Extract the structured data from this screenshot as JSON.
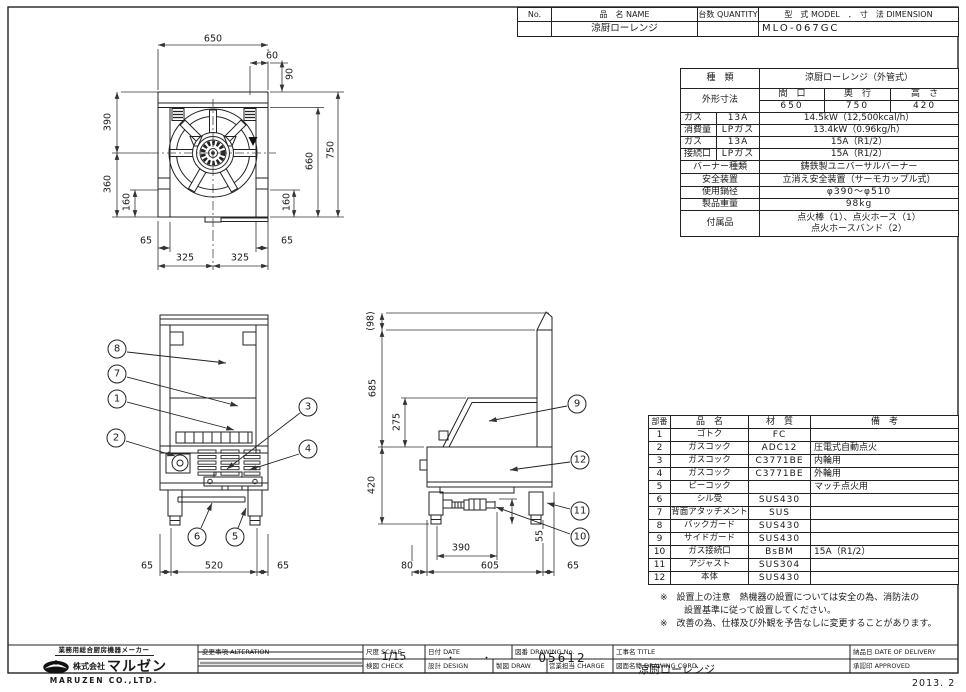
{
  "doc_header": {
    "no_label": "No.",
    "name_label": "品　名 NAME",
    "qty_label": "台数 QUANTITY",
    "model_label": "型　式 MODEL　．　寸　法 DIMENSION",
    "name_value": "涼厨ローレンジ",
    "model_value": "MLO-067GC"
  },
  "spec_table": {
    "kind_label": "種　類",
    "kind_value": "涼厨ローレンジ（外管式）",
    "dims_label": "外形寸法",
    "dims_cols": [
      "間　口",
      "奥　行",
      "高　さ"
    ],
    "dims_vals": [
      "650",
      "750",
      "420"
    ],
    "gas_rows": [
      {
        "c1": "ガス",
        "c2": "13A",
        "c3": "14.5kW（12,500kcal/h）"
      },
      {
        "c1": "消費量",
        "c2": "LPガス",
        "c3": "13.4kW（0.96kg/h）"
      },
      {
        "c1": "ガス",
        "c2": "13A",
        "c3": "15A（R1/2）"
      },
      {
        "c1": "接続口",
        "c2": "LPガス",
        "c3": "15A（R1/2）"
      }
    ],
    "info_rows": [
      {
        "label": "バーナー種類",
        "value": "鋳鉄製ユニバーサルバーナー"
      },
      {
        "label": "安全装置",
        "value": "立消え安全装置（サーモカップル式）"
      },
      {
        "label": "使用鍋径",
        "value": "φ390～φ510"
      },
      {
        "label": "製品重量",
        "value": "98kg"
      }
    ],
    "accessory_label": "付属品",
    "accessory_line1": "点火棒（1）、点火ホース（1）",
    "accessory_line2": "点火ホースバンド（2）"
  },
  "parts_table": {
    "headers": [
      "部番",
      "品　名",
      "材　質",
      "備　考"
    ],
    "rows": [
      {
        "no": "1",
        "name": "ゴトク",
        "material": "FC",
        "note": ""
      },
      {
        "no": "2",
        "name": "ガスコック",
        "material": "ADC12",
        "note": "圧電式自動点火"
      },
      {
        "no": "3",
        "name": "ガスコック",
        "material": "C3771BE",
        "note": "内輪用"
      },
      {
        "no": "4",
        "name": "ガスコック",
        "material": "C3771BE",
        "note": "外輪用"
      },
      {
        "no": "5",
        "name": "ピーコック",
        "material": "",
        "note": "マッチ点火用"
      },
      {
        "no": "6",
        "name": "シル受",
        "material": "SUS430",
        "note": ""
      },
      {
        "no": "7",
        "name": "背面アタッチメント",
        "material": "SUS",
        "note": ""
      },
      {
        "no": "8",
        "name": "バックガード",
        "material": "SUS430",
        "note": ""
      },
      {
        "no": "9",
        "name": "サイドガード",
        "material": "SUS430",
        "note": ""
      },
      {
        "no": "10",
        "name": "ガス接続口",
        "material": "BsBM",
        "note": "15A（R1/2）"
      },
      {
        "no": "11",
        "name": "アジャスト",
        "material": "SUS304",
        "note": ""
      },
      {
        "no": "12",
        "name": "本体",
        "material": "SUS430",
        "note": ""
      }
    ]
  },
  "notes": {
    "line1": "※　設置上の注意　熱機器の設置については安全の為、消防法の",
    "line2": "設置基準に従って設置してください。",
    "line3": "※　改善の為、仕様及び外観を予告なしに変更することがあります。"
  },
  "views": {
    "top": {
      "dims": {
        "w650": "650",
        "d60": "60",
        "d90": "90",
        "d390": "390",
        "d360": "360",
        "d160l": "160",
        "d660": "660",
        "d750": "750",
        "d160r": "160",
        "d65l": "65",
        "d65r": "65",
        "d325a": "325",
        "d325b": "325"
      }
    },
    "front": {
      "dims": {
        "d65l": "65",
        "d520": "520",
        "d65r": "65"
      },
      "callouts": {
        "c8": "8",
        "c7": "7",
        "c1": "1",
        "c2": "2",
        "c3": "3",
        "c4": "4",
        "c6": "6",
        "c5": "5"
      }
    },
    "side": {
      "dims": {
        "d98": "(98)",
        "d685": "685",
        "d275": "275",
        "d420": "420",
        "d55": "55",
        "d390": "390",
        "d80": "80",
        "d605": "605",
        "d65": "65"
      },
      "callouts": {
        "c9": "9",
        "c12": "12",
        "c11": "11",
        "c10": "10"
      }
    }
  },
  "title_block": {
    "maker_tagline": "業務用総合厨房機器メーカー",
    "company_prefix": "株式会社",
    "company": "マルゼン",
    "company_en": "MARUZEN  CO.,LTD.",
    "alteration_label": "変更事項 ALTERATION",
    "scale_label": "尺度 SCALE",
    "scale_value": "1/15",
    "date_label": "日付 DATE",
    "date_value": "・　　　・",
    "drawing_no_label": "図番 DRAWING No.",
    "drawing_no_value": "05612",
    "title_label": "工事名 TITLE",
    "delivery_label": "納品日 DATE OF DELIVERY",
    "check_label": "検図 CHECK",
    "design_label": "設計 DESIGN",
    "draw_label": "製図 DRAW",
    "charge_label": "営業担当 CHARGE",
    "cord_label": "図面名称 DRAWING CORD",
    "cord_value": "涼厨ローレンジ",
    "approved_label": "承認印 APPROVED",
    "issue_date": "2013. 2"
  }
}
